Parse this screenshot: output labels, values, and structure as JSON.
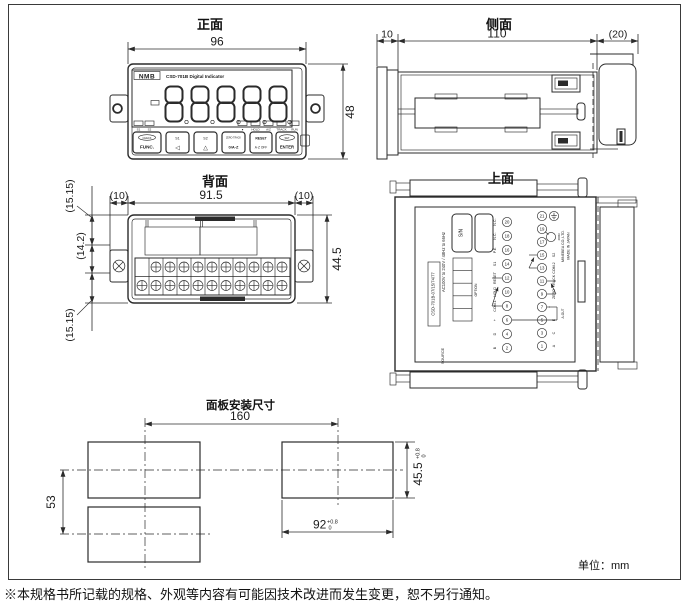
{
  "page": {
    "unit_label": "单位：mm",
    "footnote": "※本规格书所记载的规格、外观等内容有可能因技术改进而发生变更，恕不另行通知。"
  },
  "front_view": {
    "title": "正面",
    "dim_width": "96",
    "dim_height": "48",
    "brand": "NMB",
    "model_text": "CSD-701B Digital Indicator",
    "display_value": "8.8.8.8.8.",
    "annunciators_left": [
      "S1",
      "S2"
    ],
    "annunciators_right": [
      "●",
      "HOLD",
      "A/Z",
      "TRACK",
      "RUN"
    ],
    "buttons": [
      {
        "top": "CHECK",
        "main": "FUNC."
      },
      {
        "top": "S1",
        "main": "◁"
      },
      {
        "top": "S2",
        "main": "△"
      },
      {
        "top": "ZERO·TRACK",
        "main": "0/A·Z"
      },
      {
        "top": "RESET",
        "main": "A·Z OFF"
      },
      {
        "top": "SET",
        "main": "ENTER"
      }
    ]
  },
  "side_view": {
    "title": "侧面",
    "dim_bezel": "10",
    "dim_depth": "110",
    "dim_rear": "(20)"
  },
  "back_view": {
    "title": "背面",
    "dim_ear_left": "(10)",
    "dim_width": "91.5",
    "dim_ear_right": "(10)",
    "dim_height": "44.5",
    "dim_top": "(15.15)",
    "dim_mid": "(14.2)",
    "dim_bottom": "(15.15)"
  },
  "top_view": {
    "title": "上面",
    "label": {
      "source": "SOURCE",
      "model": "CSD-701B-07/15/74/77",
      "power": "AC100V to 240V / 48Hz to 66Hz",
      "sn": "S/N",
      "option": "OPTION",
      "maker": "MINEBEA CO.,LTD.",
      "origin": "MADE IN JAPAN",
      "resistor": "400Ω",
      "aout": "A-OUT",
      "terminals_even": {
        "numbers": [
          "20",
          "18",
          "16",
          "14",
          "12",
          "10",
          "8",
          "6",
          "4",
          "2"
        ],
        "labels": [
          "N.C.",
          "N.C.",
          "P.E.",
          "S1",
          "RESET",
          "HOLD",
          "COM.1",
          "+",
          "D",
          "B"
        ]
      },
      "terminals_odd": {
        "numbers": [
          "21",
          "19",
          "17",
          "15",
          "13",
          "11",
          "9",
          "7",
          "5",
          "3",
          "1"
        ],
        "labels": [
          "",
          "",
          "",
          "S2",
          "COM.2",
          "TRACK",
          "ZERO",
          "−",
          "E",
          "C",
          "A"
        ]
      }
    }
  },
  "panel_cutout": {
    "title": "面板安装尺寸",
    "dim_span_h": "160",
    "dim_span_v": "53",
    "dim_cut_w": "92",
    "dim_cut_h": "45.5",
    "tol_plus": "+0.8",
    "tol_minus": "0"
  }
}
